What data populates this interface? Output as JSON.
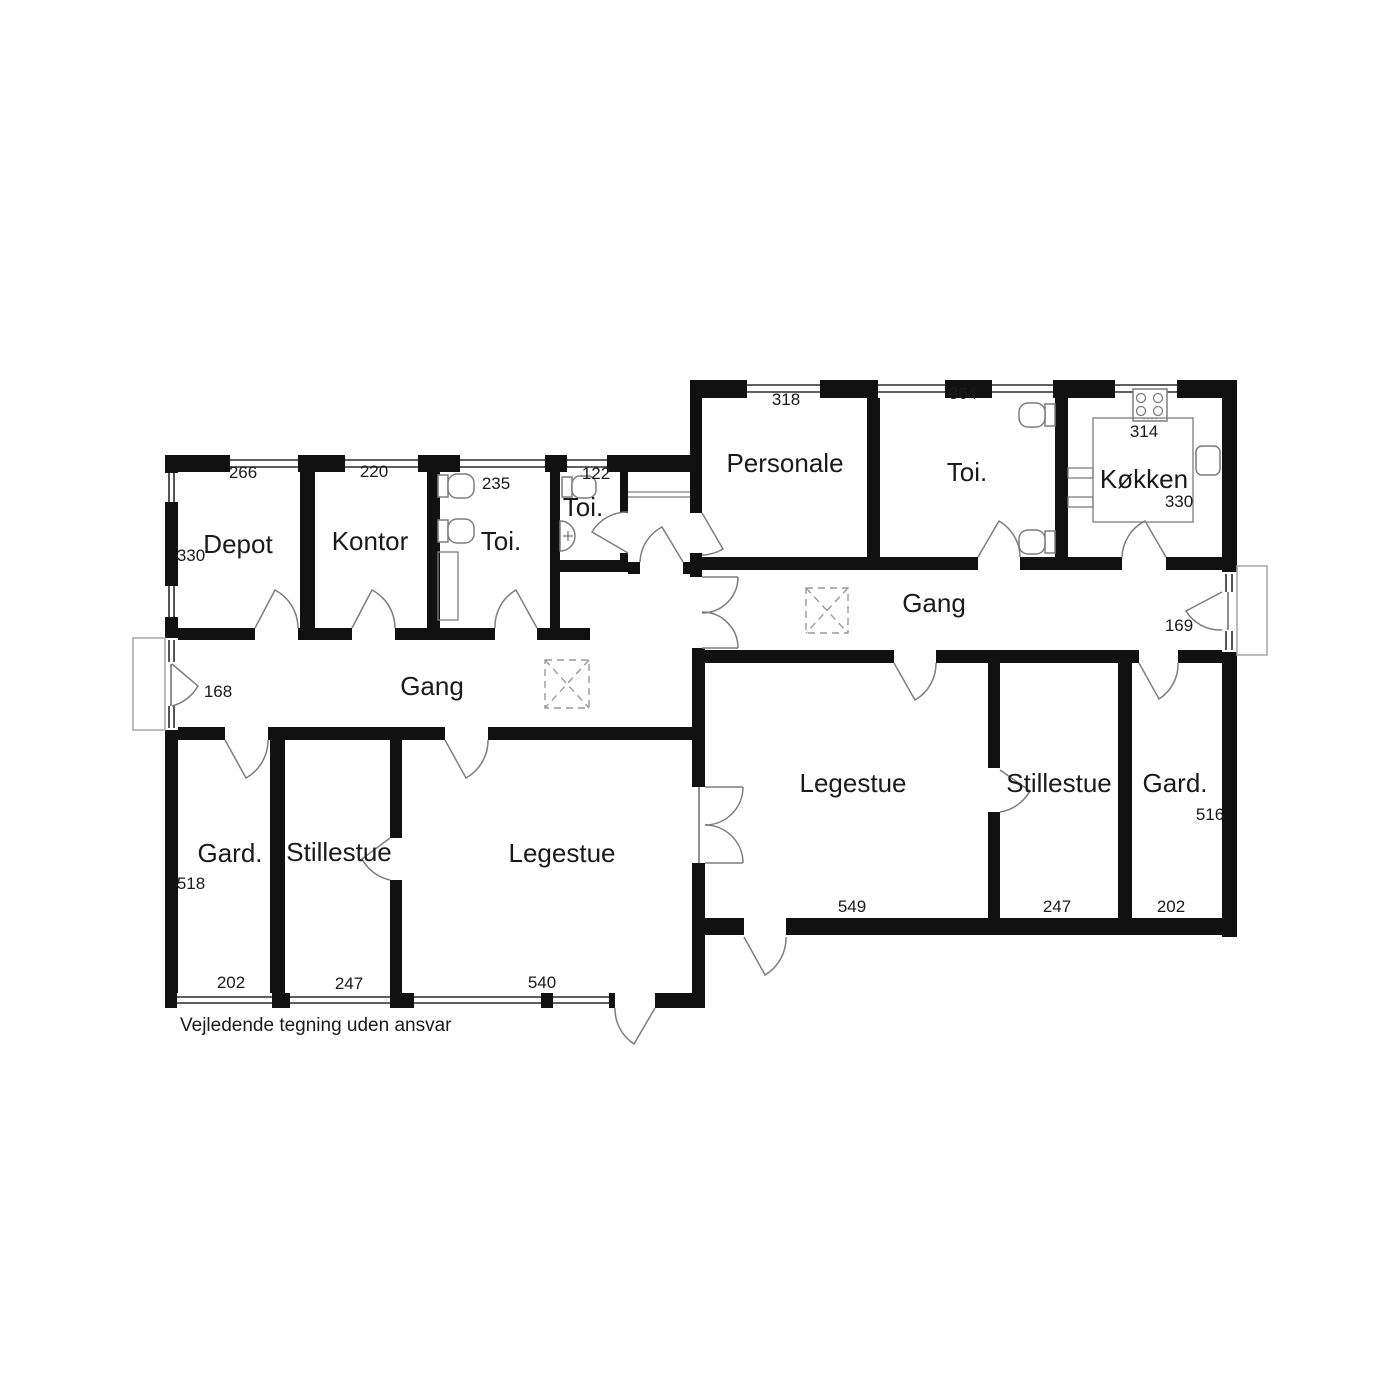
{
  "caption": "Vejledende tegning uden ansvar",
  "rooms": {
    "depot": {
      "label": "Depot",
      "width": "266",
      "depth": "330"
    },
    "kontor": {
      "label": "Kontor",
      "width": "220"
    },
    "toi_left": {
      "label": "Toi.",
      "width": "235"
    },
    "toi_small": {
      "label": "Toi.",
      "width": "122"
    },
    "gang_left": {
      "label": "Gang",
      "width": "168"
    },
    "gard_left": {
      "label": "Gard.",
      "width": "202",
      "depth": "518"
    },
    "stillestue_left": {
      "label": "Stillestue",
      "width": "247"
    },
    "legestue_left": {
      "label": "Legestue",
      "width": "540"
    },
    "personale": {
      "label": "Personale",
      "width": "318"
    },
    "toi_right": {
      "label": "Toi.",
      "width": "364"
    },
    "koekken": {
      "label": "Køkken",
      "width": "314",
      "depth": "330"
    },
    "gang_right": {
      "label": "Gang",
      "width": "169"
    },
    "legestue_right": {
      "label": "Legestue",
      "width": "549"
    },
    "stillestue_right": {
      "label": "Stillestue",
      "width": "247"
    },
    "gard_right": {
      "label": "Gard.",
      "width": "202",
      "depth": "516"
    }
  },
  "icons": [
    "toilet-icon",
    "sink-icon",
    "stove-icon",
    "kitchen-sink-icon",
    "kitchen-counter-icon",
    "door-swing-icon",
    "window-icon",
    "hatch-icon"
  ],
  "colors": {
    "background": "#ffffff",
    "wall": "#111111",
    "fixture_line": "#7d7d7d",
    "dashed_line": "#9a9a9a"
  }
}
